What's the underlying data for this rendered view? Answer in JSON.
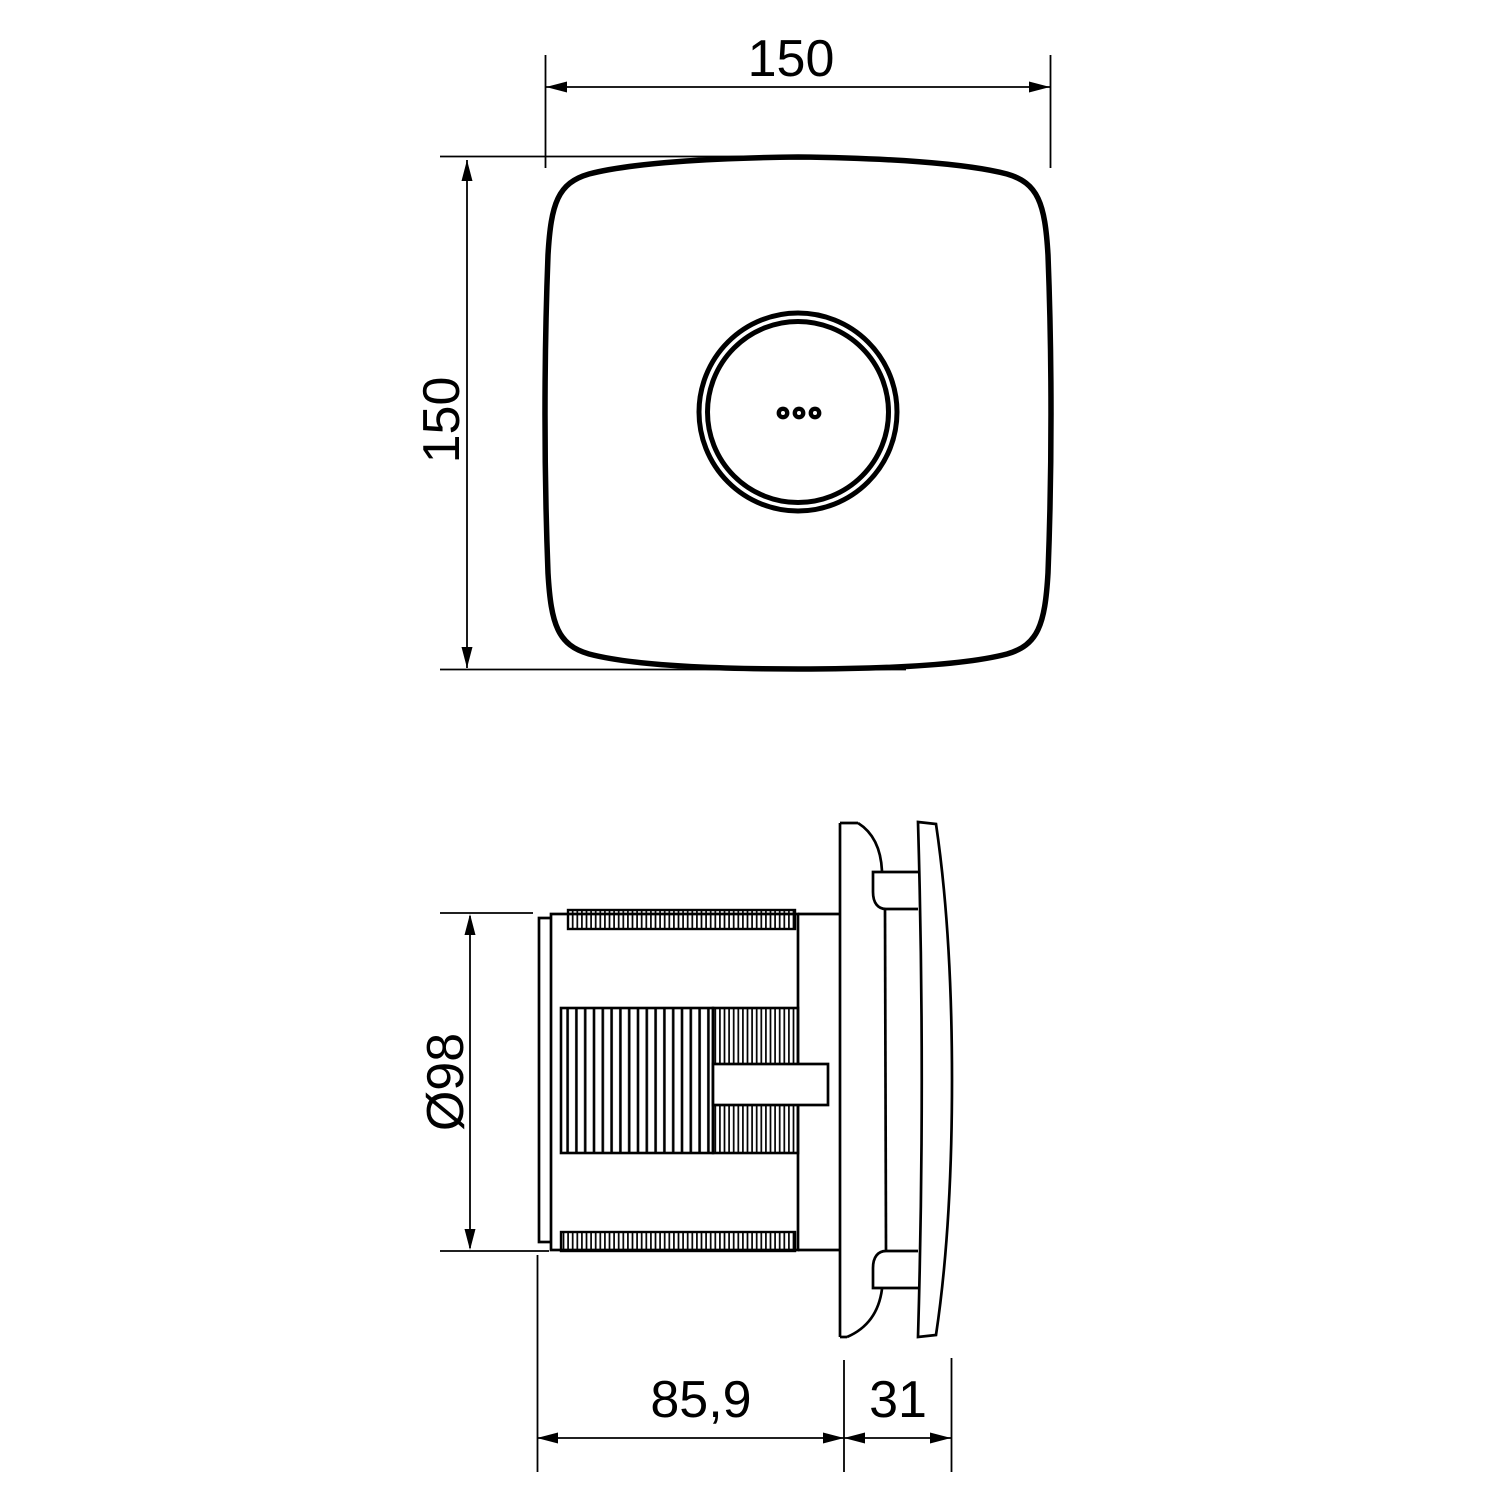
{
  "colors": {
    "background": "#ffffff",
    "ink": "#000000"
  },
  "dimensions": {
    "front_width": "150",
    "front_height": "150",
    "duct_diameter": "Ø98",
    "body_depth": "85,9",
    "cover_depth": "31"
  }
}
